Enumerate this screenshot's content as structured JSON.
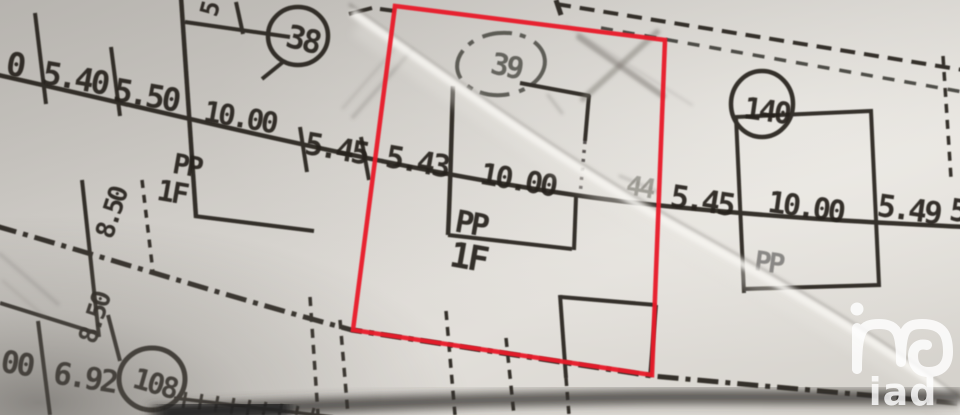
{
  "colors": {
    "highlight": "#e81c2c",
    "ink": "#26231e",
    "paper": "#d9d6d1",
    "pencil": "#78746d",
    "logo": "#ffffff"
  },
  "labels": {
    "edge_left_partial": "0",
    "dim_540": "5.40",
    "dim_550": "5.50",
    "dim_1000_left": "10.00",
    "dim_545_left": "5.45",
    "dim_543": "5.43",
    "dim_1000_center": "10.00",
    "dim_44_faint": "44",
    "dim_545_right": "5.45",
    "dim_1000_right": "10.00",
    "dim_549": "5.49",
    "dim_partial_right": "5",
    "rot_tick_top": "5",
    "dim_850_upper": "8.50",
    "dim_850_lower": "8.50",
    "dim_00": "00",
    "dim_692": "6.92",
    "circle_38": "38",
    "circle_39": "39",
    "circle_140": "140",
    "circle_108": "108",
    "pp_parcel38": "PP",
    "f1_parcel38": "1F",
    "pp_parcel39": "PP",
    "f1_parcel39": "1F",
    "pp_parcel140": "PP",
    "logo_text": "iad"
  }
}
